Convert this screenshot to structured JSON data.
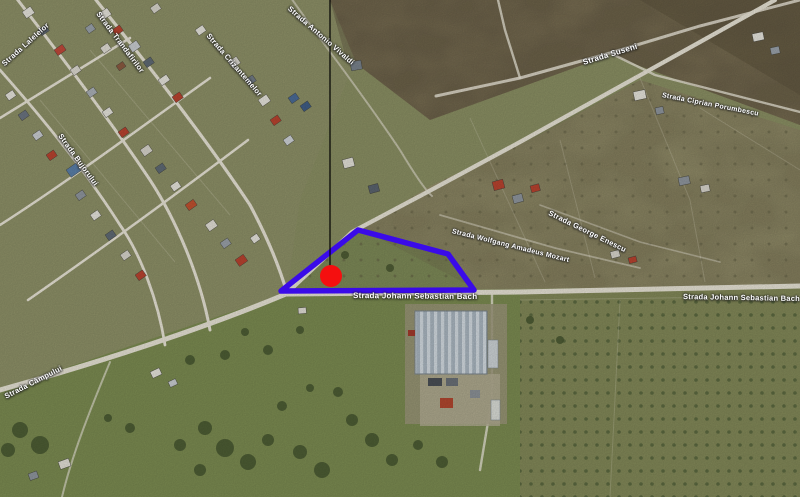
{
  "map": {
    "kind": "satellite-aerial-view",
    "street_labels": {
      "main_center": "Strada Johann Sebastian Bach",
      "main_right": "Strada Johann Sebastian Bach",
      "top_center": "Strada Antonio Vivaldi",
      "parcel_top": "Strada Wolfgang Amadeus Mozart",
      "mid_right": "Strada George Enescu",
      "upper_right_1": "Strada Suseni",
      "upper_right_2": "Strada Ciprian Porumbescu",
      "top_left": "Strada Lalelelor",
      "residential_1": "Strada Trandafirilor",
      "residential_2": "Strada Crizantemelor",
      "residential_3": "Strada Bujorului",
      "bottom_left": "Strada Câmpului"
    },
    "overlay": {
      "parcel_outline_color": "#3a0be8",
      "parcel_points": "358,230 448,254 474,290 281,291",
      "marker_color": "#f50f0f",
      "marker_x": 331,
      "marker_y": 276,
      "marker_radius": 11,
      "leader_line_color": "#000000",
      "leader_line_x": 330
    },
    "terrain_palette": {
      "field_green": "#7d8957",
      "field_tan": "#938e6a",
      "field_brown": "#7b7054",
      "scrub_dark": "#675d44",
      "grass_bright": "#7b8b51",
      "road": "#e7e3d5"
    }
  }
}
